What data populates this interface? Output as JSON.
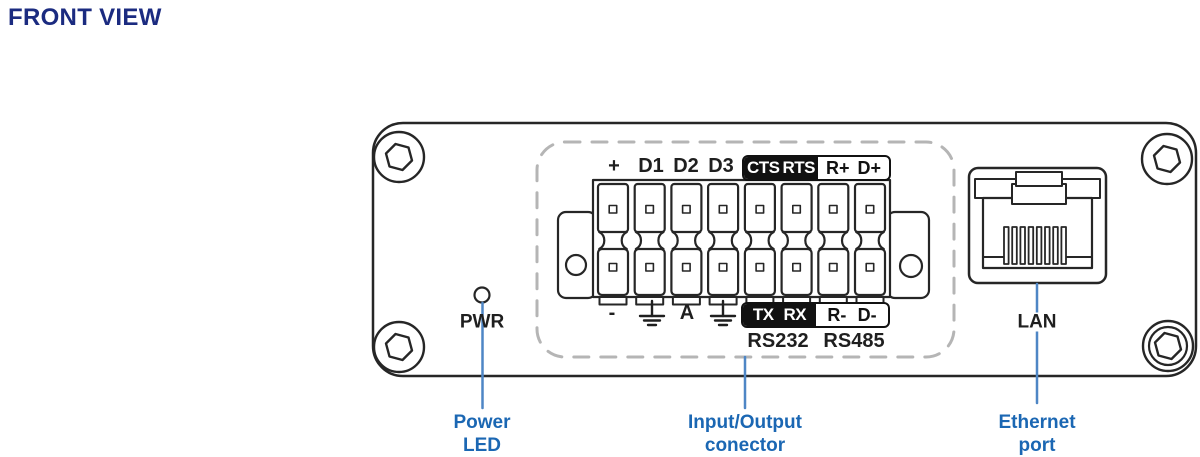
{
  "title": "FRONT VIEW",
  "colors": {
    "title_navy": "#1b2b80",
    "callout_blue": "#1b67b3",
    "callout_line_blue": "#4e86c5",
    "diagram_ink": "#262626",
    "badge_black": "#111111"
  },
  "device": {
    "pwr_label": "PWR",
    "lan_label": "LAN"
  },
  "io_connector": {
    "top_pins": [
      "+",
      "D1",
      "D2",
      "D3"
    ],
    "top_badge_dark": [
      "CTS",
      "RTS"
    ],
    "top_badge_light": [
      "R+",
      "D+"
    ],
    "bottom_pins": [
      "-",
      "A"
    ],
    "bottom_badge_dark": [
      "TX",
      "RX"
    ],
    "bottom_badge_light": [
      "R-",
      "D-"
    ],
    "serial_labels": [
      "RS232",
      "RS485"
    ]
  },
  "callouts": {
    "power_led": "Power\nLED",
    "io_connector": "Input/Output\nconector",
    "ethernet": "Ethernet\nport"
  }
}
